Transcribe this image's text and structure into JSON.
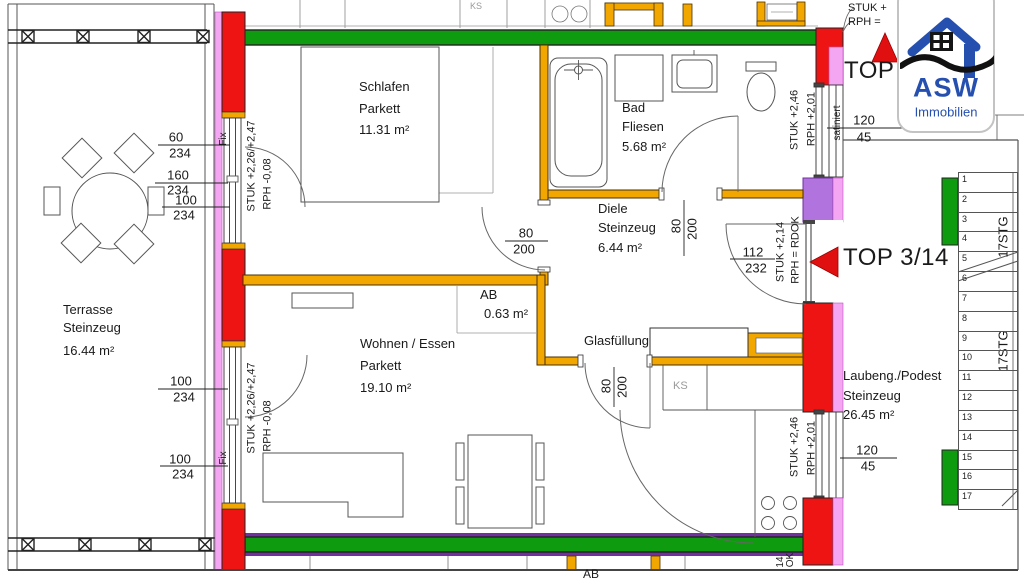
{
  "rooms": {
    "terrasse": {
      "name": "Terrasse",
      "floor": "Steinzeug",
      "area": "16.44 m²"
    },
    "schlafen": {
      "name": "Schlafen",
      "floor": "Parkett",
      "area": "11.31 m²"
    },
    "bad": {
      "name": "Bad",
      "floor": "Fliesen",
      "area": "5.68 m²"
    },
    "diele": {
      "name": "Diele",
      "floor": "Steinzeug",
      "area": "6.44 m²"
    },
    "ab": {
      "name": "AB",
      "area": "0.63 m²"
    },
    "wohnen": {
      "name": "Wohnen / Essen",
      "floor": "Parkett",
      "area": "19.10 m²"
    },
    "laubengang": {
      "name": "Laubeng./Podest",
      "floor": "Steinzeug",
      "area": "26.45 m²"
    }
  },
  "labels": {
    "glasfuellung": "Glasfüllung",
    "ks": "KS",
    "ks_top": "KS",
    "fix": "Fix",
    "satiniert": "satiniert",
    "top3": "TOP 3",
    "top314": "TOP 3/14",
    "stuk_226": "STUK +2,26/+2,47",
    "rph_008": "RPH  -0,08",
    "stuk_246": "STUK +2,46",
    "rph_201": "RPH  +2,01",
    "stuk_214": "STUK +2,14",
    "rph_rdok": "RPH = RDOK",
    "stuk_partial": "STUK +",
    "rph_partial": "RPH =",
    "ok_bottom": "OK",
    "n14_bottom": "14",
    "ab_bottom": "AB"
  },
  "dims": {
    "win60": {
      "top": "60",
      "bot": "234"
    },
    "win160": {
      "top": "160",
      "bot": "234"
    },
    "win100a": {
      "top": "100",
      "bot": "234"
    },
    "win100b": {
      "top": "100",
      "bot": "234"
    },
    "win100c": {
      "top": "100",
      "bot": "234"
    },
    "door80a": {
      "top": "80",
      "bot": "200"
    },
    "door80b": {
      "top": "80",
      "bot": "200"
    },
    "door80c": {
      "top": "80",
      "bot": "200"
    },
    "entry": {
      "top": "112",
      "bot": "232"
    },
    "win120a": {
      "top": "120",
      "bot": "45"
    },
    "win120b": {
      "top": "120",
      "bot": "45"
    }
  },
  "stairs": {
    "label": "17STG",
    "steps": [
      "1",
      "2",
      "3",
      "4",
      "5",
      "6",
      "7",
      "8",
      "9",
      "10",
      "11",
      "12",
      "13",
      "14",
      "15",
      "16",
      "17"
    ]
  },
  "logo": {
    "name": "ASW",
    "sub": "Immobilien"
  },
  "colors": {
    "wall_green": "#0f9b0f",
    "wall_red": "#ee1414",
    "wall_pink": "#f4a6f2",
    "wall_violet": "#b173dd",
    "violet_line": "#7030a0",
    "wall_orange": "#f2a600",
    "logo_blue": "#2550b0",
    "arrow_red": "#e01010"
  }
}
